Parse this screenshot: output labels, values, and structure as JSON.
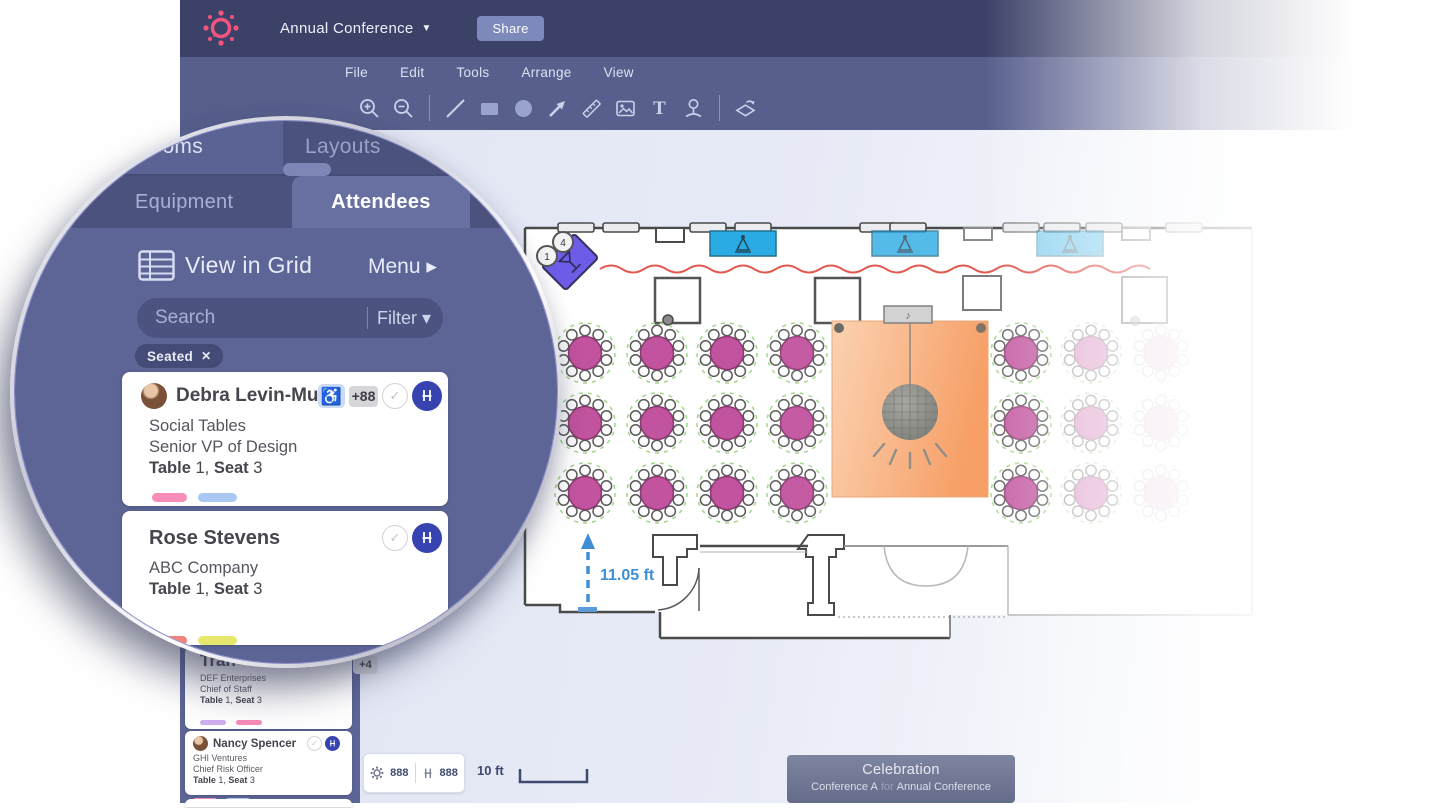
{
  "topbar": {
    "event_title": "Annual Conference",
    "title_caret": "▼",
    "share_label": "Share"
  },
  "menubar": {
    "items": [
      "File",
      "Edit",
      "Tools",
      "Arrange",
      "View"
    ]
  },
  "toolbar": {
    "icons": [
      "zoom-in",
      "zoom-out",
      "line-tool",
      "rectangle-tool",
      "ellipse-tool",
      "arrow-tool",
      "ruler-tool",
      "image-tool",
      "text-tool",
      "attendee-pin-tool",
      "flip-tool"
    ],
    "text_tool_glyph": "T"
  },
  "sidebar": {
    "top_tabs": [
      {
        "label": "Rooms"
      },
      {
        "label": "Layouts"
      }
    ],
    "panel_tabs": [
      {
        "label": "Equipment"
      },
      {
        "label": "Attendees"
      }
    ],
    "view_in_grid_label": "View in Grid",
    "menu_label": "Menu ▸",
    "search_placeholder": "Search",
    "filter_label": "Filter",
    "filter_caret": "▾",
    "seated_chip": {
      "label": "Seated",
      "close_glyph": "✕"
    },
    "check_glyph": "✓",
    "wheelchair_glyph": "♿",
    "magnified_attendees": [
      {
        "name": "Debra Levin-Mu...",
        "company": "Social Tables",
        "title": "Senior VP of Design",
        "table_label": "Table",
        "table_num": "1,",
        "seat_label": "Seat",
        "seat_num": "3",
        "extra_badge": "+88",
        "tag_colors": [
          "#f78db8",
          "#a9c9f2"
        ]
      },
      {
        "name": "Rose Stevens",
        "company": "ABC Company",
        "title": "",
        "table_label": "Table",
        "table_num": "1,",
        "seat_label": "Seat",
        "seat_num": "3",
        "tag_colors": [
          "#f3837a",
          "#e7e76e"
        ]
      }
    ],
    "attendees": [
      {
        "name": "Tran",
        "company": "DEF Enterprises",
        "title": "Chief of Staff",
        "table_label": "Table",
        "table_num": "1,",
        "seat_label": "Seat",
        "seat_num": "3",
        "extra_badge": "+4",
        "tag_colors": [
          "#cfaff0",
          "#f78db8"
        ]
      },
      {
        "name": "Nancy Spencer",
        "company": "GHI Ventures",
        "title": "Chief Risk Officer",
        "table_label": "Table",
        "table_num": "1,",
        "seat_label": "Seat",
        "seat_num": "3",
        "tag_colors": [
          "#f78db8",
          "#a9c9f2"
        ]
      }
    ]
  },
  "statusbar": {
    "table_count": "888",
    "seat_count": "888",
    "scale_label": "10 ft"
  },
  "floorplan": {
    "measurement_label": "11.05 ft",
    "bar_badges": [
      "1",
      "4"
    ],
    "music_note_glyph": "♪",
    "colors": {
      "table": "#c2539e",
      "table_stroke": "#8d3a72",
      "spacing_guide": "#a5d88f",
      "dance_floor_light": "#fbd2b2",
      "dance_floor_dark": "#f79f66",
      "station_blue": "#2aabe3",
      "queue_line_red": "#e25950",
      "bar_purple": "#6c5ce7",
      "measure_blue": "#3f8fd4",
      "wall": "#4a4a4a"
    },
    "left_tables": {
      "cx": [
        585,
        657,
        727,
        797
      ],
      "cy": [
        353,
        423,
        493
      ],
      "col_opacity": [
        1,
        1,
        1,
        0.95
      ]
    },
    "right_tables": {
      "cx": [
        1021,
        1091,
        1161
      ],
      "cy": [
        353,
        423,
        493
      ],
      "col_opacity": [
        0.9,
        0.45,
        0.16
      ]
    }
  },
  "footer_label": {
    "title": "Celebration",
    "room": "Conference A",
    "for_word": "for",
    "event": "Annual Conference"
  }
}
